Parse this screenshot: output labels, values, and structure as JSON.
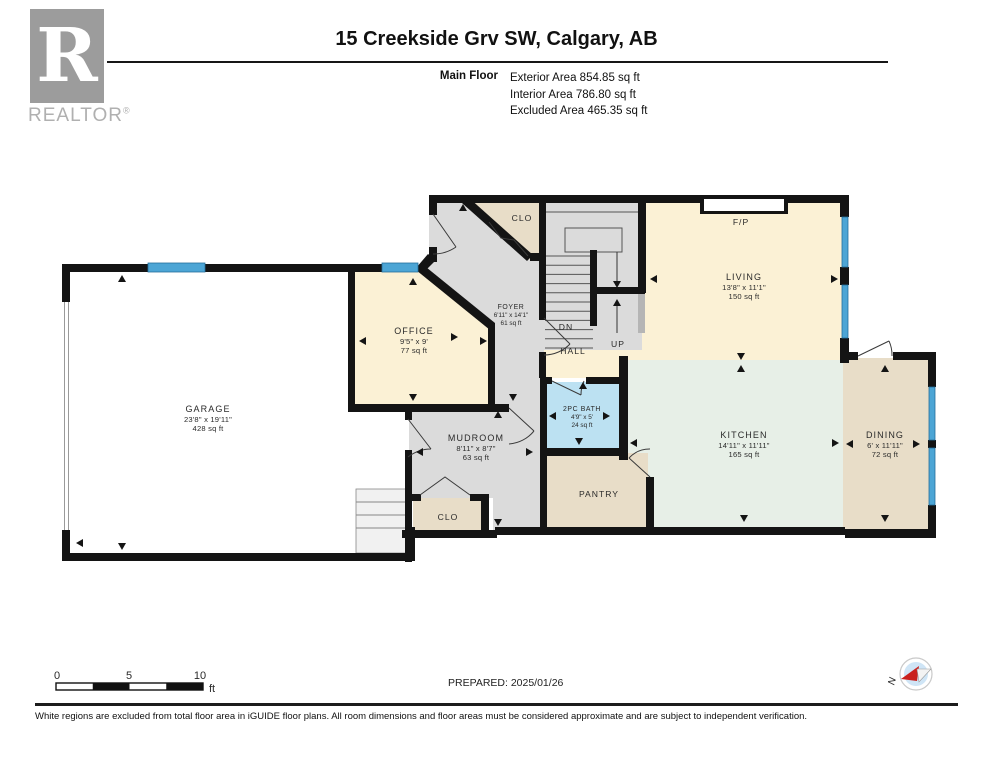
{
  "header": {
    "brand": {
      "letter": "R",
      "name": "REALTOR",
      "reg": "®"
    },
    "title": "15 Creekside Grv SW, Calgary, AB",
    "floor_label": "Main Floor",
    "areas": [
      "Exterior Area 854.85 sq ft",
      "Interior Area 786.80 sq ft",
      "Excluded Area 465.35 sq ft"
    ]
  },
  "rooms": [
    {
      "name": "GARAGE",
      "dims": "23'8\" x 19'11\"",
      "area": "428 sq ft"
    },
    {
      "name": "OFFICE",
      "dims": "9'5\" x 9'",
      "area": "77 sq ft"
    },
    {
      "name": "FOYER",
      "dims": "6'11\" x 14'1\"",
      "area": "61 sq ft"
    },
    {
      "name": "LIVING",
      "dims": "13'8\" x 11'1\"",
      "area": "150 sq ft"
    },
    {
      "name": "KITCHEN",
      "dims": "14'11\" x 11'11\"",
      "area": "165 sq ft"
    },
    {
      "name": "DINING",
      "dims": "6' x 11'11\"",
      "area": "72 sq ft"
    },
    {
      "name": "MUDROOM",
      "dims": "8'11\" x 8'7\"",
      "area": "63 sq ft"
    },
    {
      "name": "2PC BATH",
      "dims": "4'9\" x 5'",
      "area": "24 sq ft"
    }
  ],
  "annotations": {
    "clo_front": "CLO",
    "clo_mudroom": "CLO",
    "hall": "HALL",
    "up": "UP",
    "dn": "DN",
    "fireplace": "F/P",
    "pantry": "PANTRY"
  },
  "scale_bar": {
    "ticks": [
      "0",
      "5",
      "10"
    ],
    "unit": "ft"
  },
  "prepared": "PREPARED: 2025/01/26",
  "compass_north": "N",
  "footer_note": "White regions are excluded from total floor area in iGUIDE floor plans. All room dimensions and floor areas must be considered approximate and are subject to independent verification.",
  "colors": {
    "wall": "#141414",
    "window_blue": "#4CA5D5",
    "excluded_white": "#FFFFFF",
    "floor_gray": "#DBDBDB",
    "floor_cream": "#FBF1D5",
    "floor_tan": "#E8DDC8",
    "floor_mint": "#E7EFE7",
    "bath_blue": "#BCE1F2",
    "compass_red": "#C9211E",
    "logo_gray": "#9C9C9C"
  }
}
